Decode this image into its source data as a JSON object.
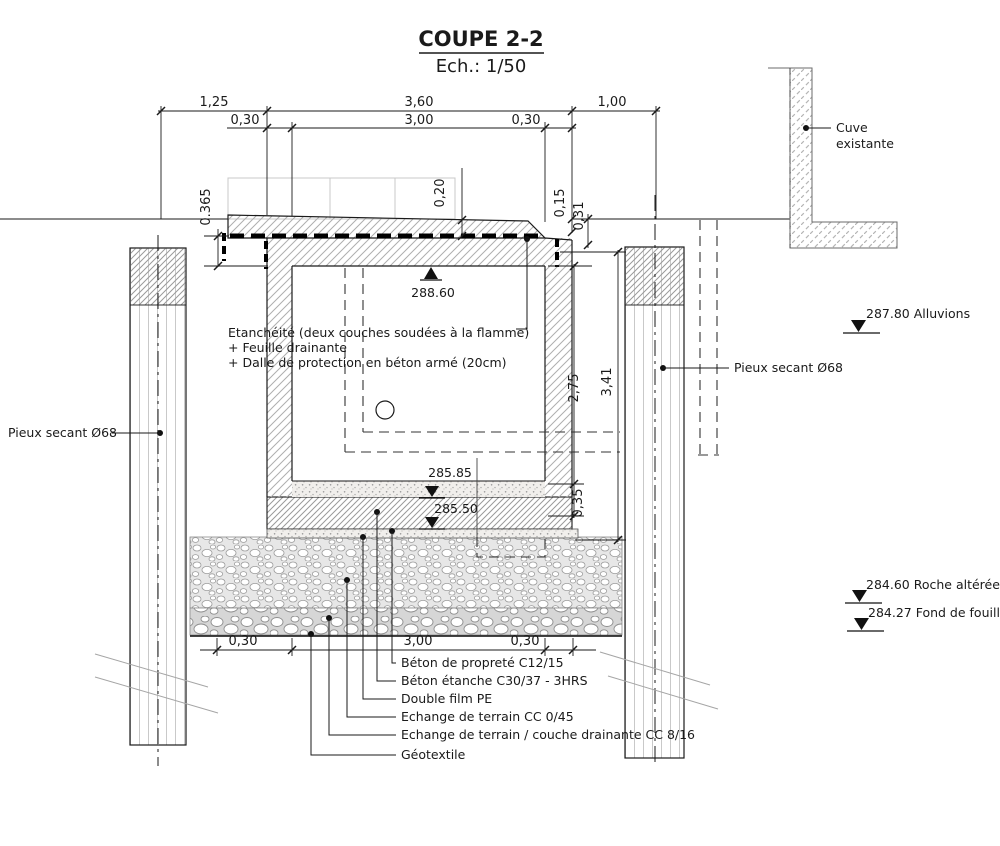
{
  "title": "COUPE 2-2",
  "scale_label": "Ech.: 1/50",
  "dimensions": {
    "top": [
      "1,25",
      "3,60",
      "1,00"
    ],
    "top_inner": [
      "0,30",
      "3,00",
      "0,30"
    ],
    "bottom": [
      "0,30",
      "3,00",
      "0,30"
    ],
    "left_offset": "0.365",
    "slab_thickness": "0,20",
    "step_1": "0,15",
    "step_2": "0,31",
    "interior_height": "2,75",
    "overall_height": "3,41",
    "base_thickness": "0,35"
  },
  "levels": {
    "roof": "288.60",
    "floor": "285.85",
    "radier": "285.50",
    "alluvions": "287.80 Alluvions",
    "roche": "284.60 Roche altérée",
    "fond": "284.27 Fond de fouille"
  },
  "callouts": {
    "cuve_line1": "Cuve",
    "cuve_line2": "existante",
    "pile_left": "Pieux secant Ø68",
    "pile_right": "Pieux secant Ø68",
    "waterproofing_1": "Etanchéité (deux couches soudées à la flamme)",
    "waterproofing_2": "+ Feuille drainante",
    "waterproofing_3": "+ Dalle de protection en béton armé (20cm)",
    "materials": [
      "Béton de propreté C12/15",
      "Béton étanche C30/37 - 3HRS",
      "Double film PE",
      "Echange de terrain CC 0/45",
      "Echange de terrain / couche drainante CC 8/16",
      "Géotextile"
    ]
  },
  "colors": {
    "ink": "#1a1a1a",
    "hatch": "#a8a8a8",
    "ghost": "#c8c8c8"
  }
}
